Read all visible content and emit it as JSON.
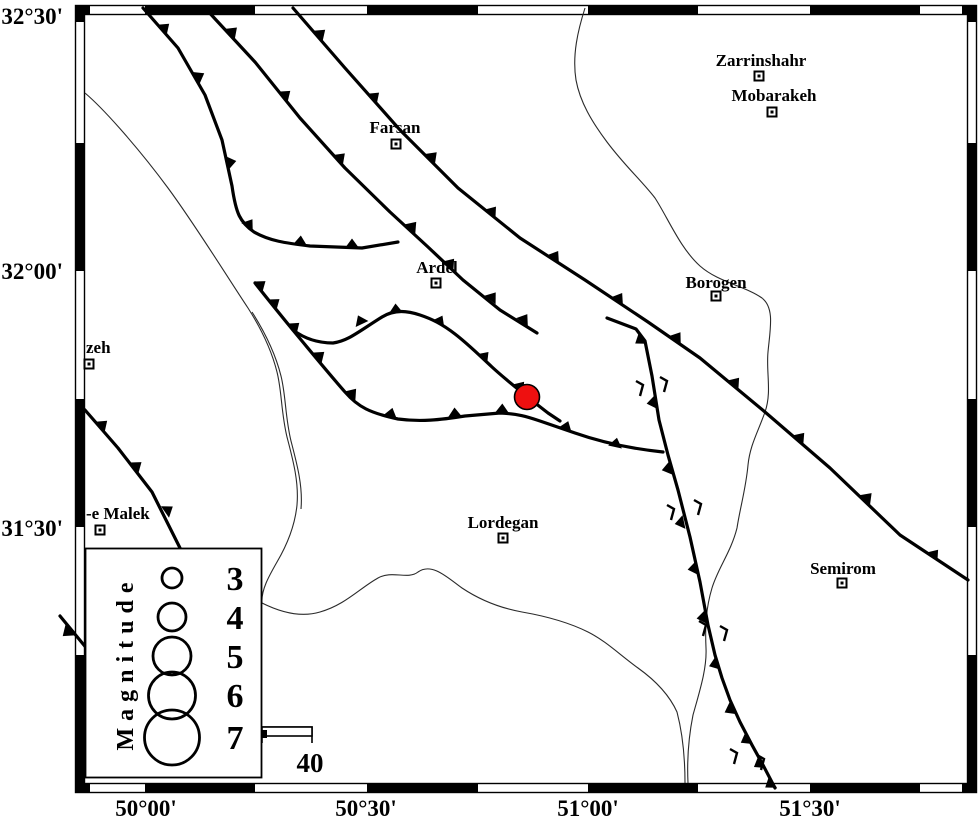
{
  "axes": {
    "y_labels": [
      "32°30'",
      "32°00'",
      "31°30'"
    ],
    "x_labels": [
      "50°00'",
      "50°30'",
      "51°00'",
      "51°30'"
    ]
  },
  "cities": [
    {
      "name": "Zarrinshahr",
      "x": 759,
      "y": 76
    },
    {
      "name": "Mobarakeh",
      "x": 772,
      "y": 112
    },
    {
      "name": "Farsan",
      "x": 396,
      "y": 144
    },
    {
      "name": "Ardel",
      "x": 436,
      "y": 283
    },
    {
      "name": "Borogen",
      "x": 716,
      "y": 296
    },
    {
      "name": "Lordegan",
      "x": 503,
      "y": 538
    },
    {
      "name": "Semirom",
      "x": 842,
      "y": 583
    },
    {
      "name": "zeh",
      "x": 89,
      "y": 364
    },
    {
      "name": "-e Malek",
      "x": 100,
      "y": 530
    }
  ],
  "epicenter": {
    "x": 527,
    "y": 397,
    "radius": 12.5,
    "color": "#ee1010"
  },
  "legend": {
    "title": "Magnitude",
    "entries": [
      {
        "label": "3",
        "radius": 10
      },
      {
        "label": "4",
        "radius": 14
      },
      {
        "label": "5",
        "radius": 19
      },
      {
        "label": "6",
        "radius": 23.5
      },
      {
        "label": "7",
        "radius": 27.5
      }
    ]
  },
  "scale_bar": {
    "label": "40"
  },
  "colors": {
    "fault": "#000000",
    "epicenter": "#ee1010",
    "background": "#ffffff"
  }
}
